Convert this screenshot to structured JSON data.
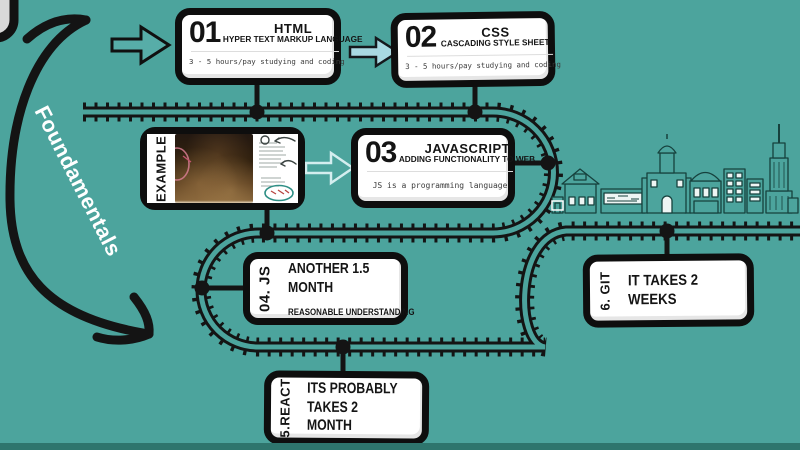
{
  "palette": {
    "background": "#4CA49D",
    "footer_strip": "#2E756D",
    "track_black": "#141414",
    "card_fill": "#FFFFFF",
    "card_border": "#0E0E0E",
    "note_gray": "#3B3B3B",
    "arrow_light_blue_fill": "#A9D9E2",
    "arrow_pale_outline": "#D4EEEF",
    "city_line": "#16413D",
    "annotation_white": "#FFFFFF"
  },
  "annotation_arrow": {
    "label": "Foundamentals"
  },
  "steps": [
    {
      "number": "01",
      "title": "HTML",
      "subtitle": "HYPER TEXT MARKUP LANGUAGE",
      "note": "3 - 5 hours/pay studying and coding"
    },
    {
      "number": "02",
      "title": "CSS",
      "subtitle": "CASCADING STYLE SHEET",
      "note": "3 - 5 hours/pay studying and coding"
    },
    {
      "number": "03",
      "title": "JAVASCRIPT",
      "subtitle": "ADDING FUNCTIONALITY TO WEB",
      "note": "JS is a programming language"
    },
    {
      "side_label": "04. JS",
      "title": "ANOTHER 1.5 MONTH",
      "note": "REASONABLE UNDERSTANDING"
    },
    {
      "side_label": "5.REACT",
      "title": "ITS PROBABLY TAKES 2 MONTH"
    },
    {
      "side_label": "6. GIT",
      "title": "IT TAKES 2 WEEKS"
    }
  ],
  "example_card": {
    "side_label": "EXAMPLE"
  },
  "icons": {
    "hand_drawn_arrow": "curved-double-headed-arrow",
    "flow_arrow": "right-block-arrow",
    "railway": "railroad-track",
    "city": "city-skyline"
  }
}
